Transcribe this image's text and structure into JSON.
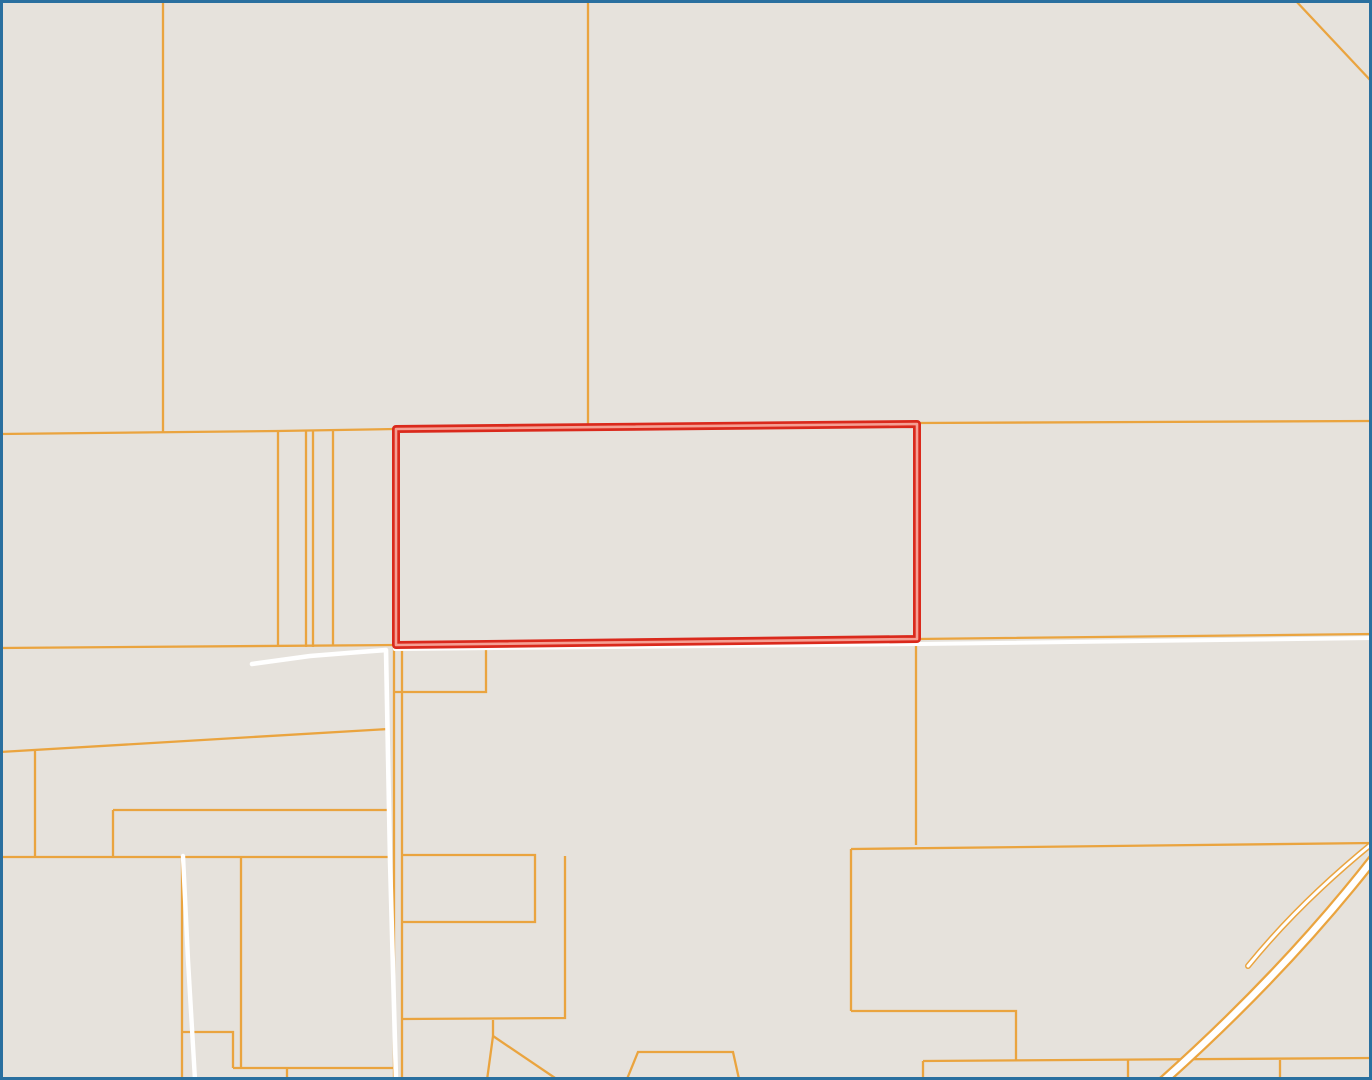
{
  "map": {
    "width": 1372,
    "height": 1080,
    "background_color": "#e6e2dc",
    "frame_border_color": "#2a6f9f",
    "frame_border_width": 3,
    "parcel_line_color": "#eaa43f",
    "parcel_line_width": 2.3,
    "road_color": "#ffffff",
    "ramp_casing_color": "#eaa43f",
    "highlight_outer_color": "#da291c",
    "highlight_inner_color": "#f59f93",
    "parcel_lines": [
      [
        [
          0,
          434
        ],
        [
          278,
          431
        ],
        [
          395,
          429
        ],
        [
          917,
          423
        ],
        [
          1372,
          421
        ]
      ],
      [
        [
          0,
          648
        ],
        [
          395,
          645
        ],
        [
          917,
          639
        ],
        [
          1372,
          634
        ]
      ],
      [
        [
          163,
          0
        ],
        [
          163,
          433
        ]
      ],
      [
        [
          588,
          0
        ],
        [
          588,
          427
        ]
      ],
      [
        [
          1295,
          0
        ],
        [
          1372,
          82
        ]
      ],
      [
        [
          278,
          431
        ],
        [
          278,
          647
        ]
      ],
      [
        [
          306,
          431
        ],
        [
          306,
          647
        ]
      ],
      [
        [
          313,
          431
        ],
        [
          313,
          647
        ]
      ],
      [
        [
          333,
          430
        ],
        [
          333,
          646
        ]
      ],
      [
        [
          0,
          752
        ],
        [
          388,
          729
        ]
      ],
      [
        [
          35,
          751
        ],
        [
          35,
          857
        ]
      ],
      [
        [
          113,
          810
        ],
        [
          388,
          810
        ]
      ],
      [
        [
          113,
          810
        ],
        [
          113,
          857
        ]
      ],
      [
        [
          0,
          857
        ],
        [
          390,
          857
        ]
      ],
      [
        [
          182,
          858
        ],
        [
          182,
          1080
        ]
      ],
      [
        [
          182,
          1032
        ],
        [
          233,
          1032
        ],
        [
          233,
          1068
        ]
      ],
      [
        [
          241,
          858
        ],
        [
          241,
          1068
        ]
      ],
      [
        [
          233,
          1068
        ],
        [
          395,
          1068
        ]
      ],
      [
        [
          287,
          1068
        ],
        [
          287,
          1080
        ]
      ],
      [
        [
          394,
          646
        ],
        [
          394,
          1080
        ]
      ],
      [
        [
          402,
          648
        ],
        [
          402,
          1080
        ]
      ],
      [
        [
          394,
          692
        ],
        [
          486,
          692
        ],
        [
          486,
          647
        ]
      ],
      [
        [
          402,
          855
        ],
        [
          535,
          855
        ],
        [
          535,
          922
        ],
        [
          402,
          922
        ]
      ],
      [
        [
          565,
          856
        ],
        [
          565,
          1018
        ],
        [
          403,
          1019
        ]
      ],
      [
        [
          493,
          1020
        ],
        [
          493,
          1036
        ],
        [
          487,
          1080
        ]
      ],
      [
        [
          493,
          1036
        ],
        [
          558,
          1080
        ]
      ],
      [
        [
          627,
          1079
        ],
        [
          638,
          1052
        ],
        [
          733,
          1052
        ],
        [
          739,
          1079
        ]
      ],
      [
        [
          916,
          640
        ],
        [
          916,
          845
        ]
      ],
      [
        [
          851,
          849
        ],
        [
          1372,
          843
        ]
      ],
      [
        [
          851,
          849
        ],
        [
          851,
          1011
        ]
      ],
      [
        [
          851,
          1011
        ],
        [
          1016,
          1011
        ],
        [
          1016,
          1061
        ]
      ],
      [
        [
          923,
          1061
        ],
        [
          1372,
          1058
        ]
      ],
      [
        [
          923,
          1061
        ],
        [
          923,
          1080
        ]
      ],
      [
        [
          1128,
          1060
        ],
        [
          1128,
          1080
        ]
      ],
      [
        [
          1280,
          1060
        ],
        [
          1280,
          1080
        ]
      ]
    ],
    "roads": [
      {
        "points": [
          [
            252,
            664
          ],
          [
            310,
            656
          ],
          [
            360,
            652
          ],
          [
            386,
            650
          ],
          [
            390,
            860
          ],
          [
            396,
            1080
          ]
        ],
        "width": 4.6
      },
      {
        "points": [
          [
            395,
            649
          ],
          [
            920,
            644
          ],
          [
            1372,
            638
          ]
        ],
        "width": 4.0
      },
      {
        "points": [
          [
            183,
            856
          ],
          [
            188,
            960
          ],
          [
            195,
            1080
          ]
        ],
        "width": 4.4
      }
    ],
    "ramps": [
      {
        "path": "M 1162,1082 Q 1285,972 1374,858",
        "casing_width": 11,
        "fill_width": 6.5
      },
      {
        "path": "M 1374,842 Q 1300,902 1248,966",
        "casing_width": 6,
        "fill_width": 3
      }
    ],
    "highlighted_parcel": {
      "points": [
        [
          396,
          429
        ],
        [
          917,
          424
        ],
        [
          917,
          639
        ],
        [
          396,
          645
        ]
      ],
      "outer_width": 8,
      "inner_width": 2.6
    }
  }
}
